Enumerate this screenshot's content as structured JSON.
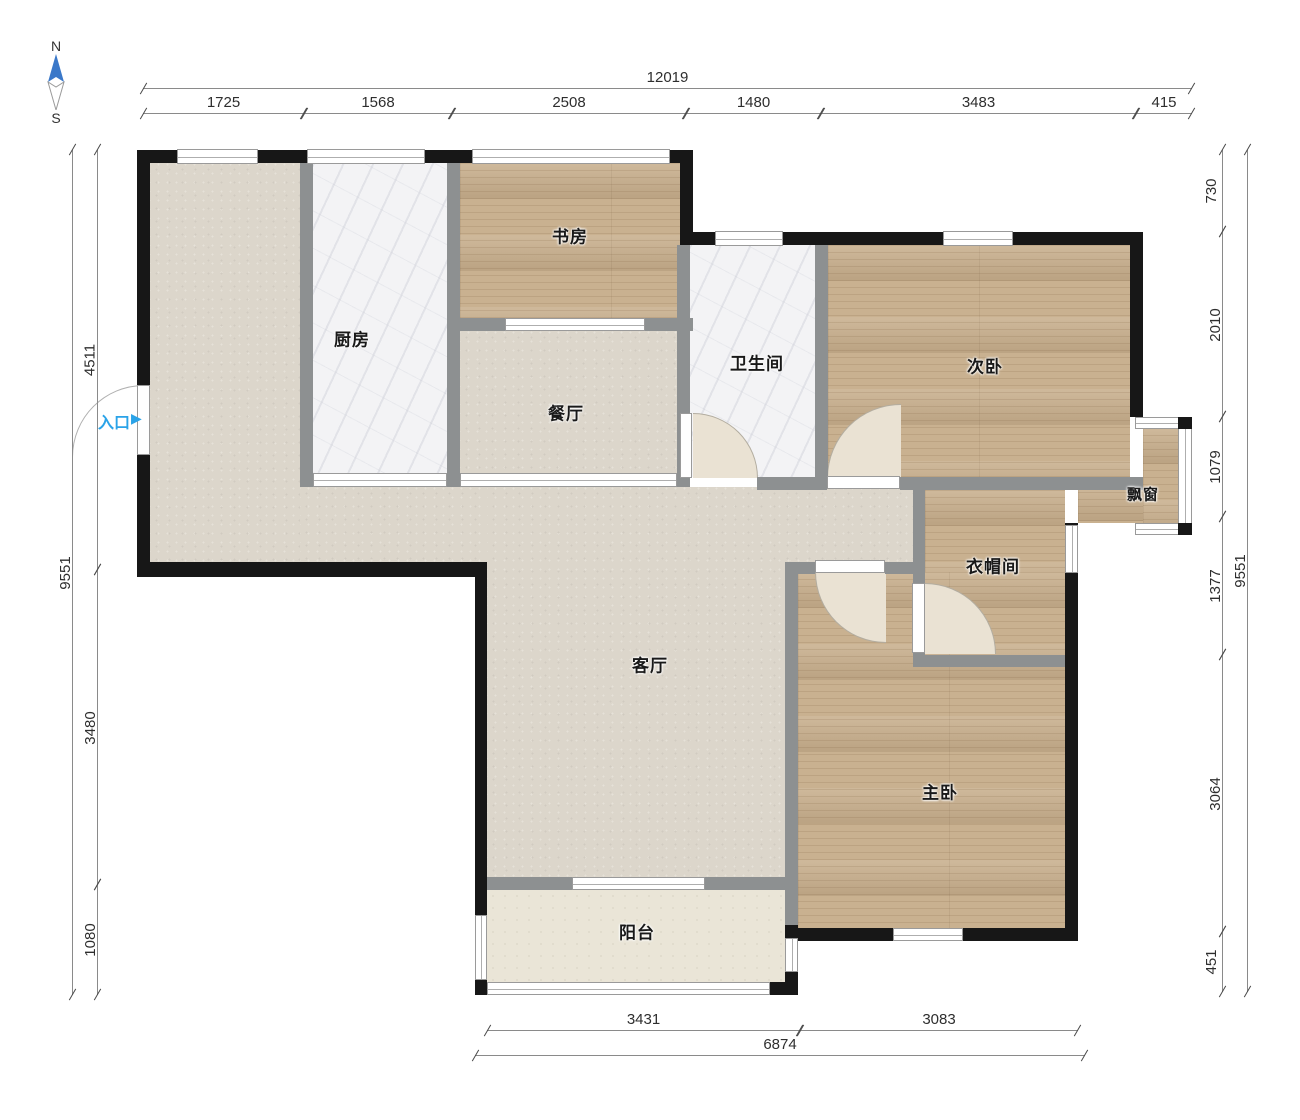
{
  "compass": {
    "north": "N",
    "south": "S"
  },
  "entrance": {
    "label": "入口",
    "arrow": "▶"
  },
  "rooms": {
    "study": {
      "label": "书房"
    },
    "kitchen": {
      "label": "厨房"
    },
    "dining": {
      "label": "餐厅"
    },
    "bathroom": {
      "label": "卫生间"
    },
    "second_bedroom": {
      "label": "次卧"
    },
    "bay_window": {
      "label": "飘窗"
    },
    "cloakroom": {
      "label": "衣帽间"
    },
    "living_room": {
      "label": "客厅"
    },
    "master_bedroom": {
      "label": "主卧"
    },
    "balcony": {
      "label": "阳台"
    }
  },
  "dims": {
    "top": {
      "total": "12019",
      "segments": [
        "1725",
        "1568",
        "2508",
        "1480",
        "3483",
        "415"
      ]
    },
    "left": {
      "total": "9551",
      "segments": [
        "4511",
        "3480",
        "1080"
      ]
    },
    "right": {
      "total": "9551",
      "segments": [
        "730",
        "2010",
        "1079",
        "1377",
        "3064",
        "451"
      ]
    },
    "bottom": {
      "total": "6874",
      "segments": [
        "3431",
        "3083"
      ]
    }
  },
  "colors": {
    "wall_black": "#171717",
    "wall_gray": "#8d9091",
    "wood_floor": "#c9b190",
    "tile_floor": "#dcd6cb",
    "marble_floor": "#f3f3f5",
    "entrance_blue": "#2aa3e8",
    "compass_blue": "#3a78c9"
  }
}
